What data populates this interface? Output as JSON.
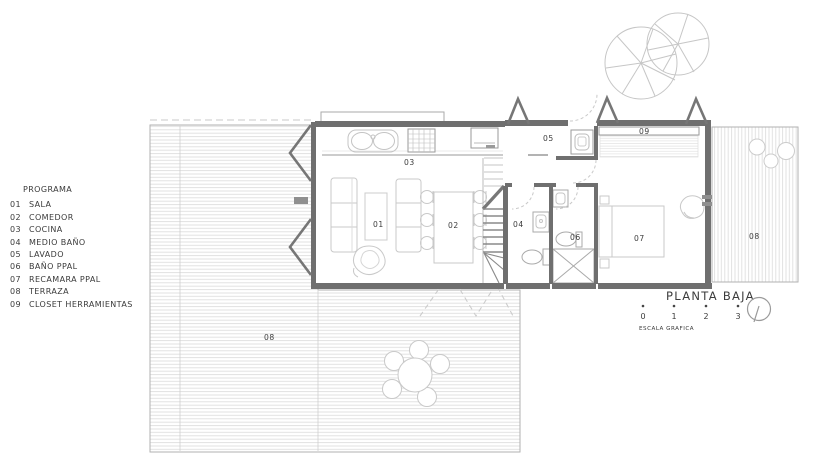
{
  "legend": {
    "title": "PROGRAMA",
    "items": [
      {
        "num": "01",
        "label": "SALA"
      },
      {
        "num": "02",
        "label": "COMEDOR"
      },
      {
        "num": "03",
        "label": "COCINA"
      },
      {
        "num": "04",
        "label": "MEDIO BAÑO"
      },
      {
        "num": "05",
        "label": "LAVADO"
      },
      {
        "num": "06",
        "label": "BAÑO PPAL"
      },
      {
        "num": "07",
        "label": "RECAMARA PPAL"
      },
      {
        "num": "08",
        "label": "TERRAZA"
      },
      {
        "num": "09",
        "label": "CLOSET HERRAMIENTAS"
      }
    ]
  },
  "plan": {
    "labels": {
      "sala": "01",
      "comedor": "02",
      "cocina": "03",
      "medio_bano": "04",
      "lavado": "05",
      "bano_ppal": "06",
      "recamara_ppal": "07",
      "terraza_principal": "08",
      "terraza_lateral": "08",
      "closet_herramientas": "09"
    }
  },
  "title_block": {
    "title": "PLANTA BAJA",
    "scale_ticks": [
      "0",
      "1",
      "2",
      "3"
    ],
    "scale_caption": "ESCALA GRAFICA"
  },
  "colors": {
    "wall": "#6f6f6f",
    "line": "#9a9a9a",
    "furniture": "#c9c9c9",
    "hatch": "#dcdcdc",
    "text": "#3c3c3c"
  }
}
